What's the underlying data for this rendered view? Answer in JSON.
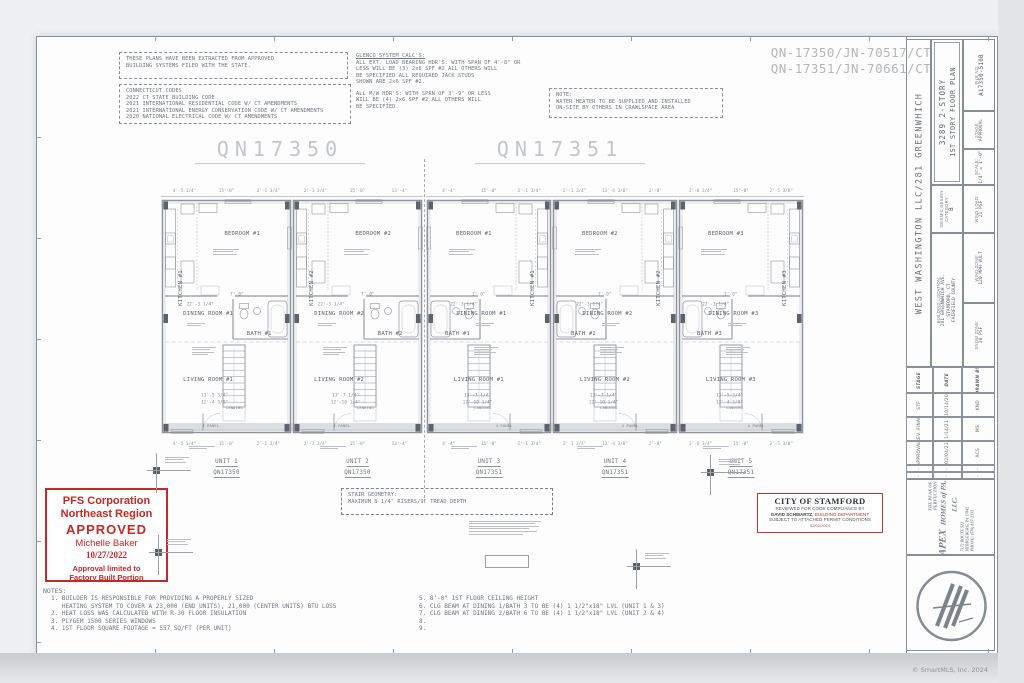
{
  "header": {
    "extract_notice": [
      "THESE PLANS HAVE BEEN EXTRACTED FROM APPROVED",
      "BUILDING SYSTEMS FILED WITH THE STATE."
    ],
    "codes": {
      "title": "CONNECTICUT CODES",
      "items": [
        "2022 CT STATE BUILDING CODE",
        "2021 INTERNATIONAL RESIDENTIAL CODE W/ CT AMENDMENTS",
        "2021 INTERNATIONAL ENERGY CONSERVATION CODE W/ CT AMENDMENTS",
        "2020 NATIONAL ELECTRICAL CODE W/ CT AMENDMENTS"
      ]
    },
    "glenco": {
      "title": "GLENCO SYSTEM CALC'S:",
      "para1": [
        "ALL EXT. LOAD BEARING HDR'S: WITH SPAN OF 4'-8\" OR",
        "LESS WILL BE (3) 2x6 SPF #2 ALL OTHERS WILL",
        "BE SPECIFIED ALL REQUIRED JACK STUDS",
        "SHOWN ARE 2x6 SPF #2."
      ],
      "para2": [
        "ALL M/W HDR'S: WITH SPAN OF 3'-9\" OR LESS",
        "WILL BE (4) 2x6 SPF #2 ALL OTHERS WILL",
        "BE SPECIFIED."
      ]
    },
    "water_note": {
      "title": "NOTE:",
      "lines": [
        "WATER HEATER TO BE SUPPLIED AND INSTALLED",
        "ON-SITE BY OTHERS IN CRAWLSPACE AREA"
      ]
    },
    "job_numbers": [
      "QN-17350/JN-70517/CT",
      "QN-17351/JN-70661/CT"
    ]
  },
  "plans": [
    {
      "title": "QN17350",
      "units": [
        {
          "name": "UNIT 1",
          "model": "QN17350",
          "mirror": false,
          "rooms": {
            "bedroom": "BEDROOM #1",
            "kitchen": "KITCHEN #1",
            "dining": "DINING ROOM #1",
            "bath": "BATH #1",
            "living": "LIVING ROOM #1",
            "landing": "LANDING",
            "door": "4 PANEL"
          },
          "dims_top": [
            "4'-5 1/4\"",
            "15'-0\"",
            "2'-1 3/4\""
          ],
          "dims_interior": [
            "7'-0\"",
            "22'-3 1/4\""
          ],
          "dims_bottom": [
            "13'-5 3/4\"",
            "12'-4 3/8\""
          ]
        },
        {
          "name": "UNIT 2",
          "model": "QN17350",
          "mirror": false,
          "rooms": {
            "bedroom": "BEDROOM #2",
            "kitchen": "KITCHEN #2",
            "dining": "DINING ROOM #2",
            "bath": "BATH #2",
            "living": "LIVING ROOM #2",
            "landing": "LANDING",
            "door": "4 PANEL"
          },
          "dims_top": [
            "2'-1 3/4\"",
            "15'-0\"",
            "13'-4\""
          ],
          "dims_interior": [
            "7'-0\"",
            "22'-3 1/4\""
          ],
          "dims_bottom": [
            "13'-7 1/4\"",
            "12'-10 1/4\""
          ]
        }
      ]
    },
    {
      "title": "QN17351",
      "units": [
        {
          "name": "UNIT 3",
          "model": "QN17351",
          "mirror": true,
          "rooms": {
            "bedroom": "BEDROOM #1",
            "kitchen": "KITCHEN #1",
            "dining": "DINING ROOM #1",
            "bath": "BATH #1",
            "living": "LIVING ROOM #1",
            "landing": "LANDING",
            "door": "4 PANEL"
          },
          "dims_top": [
            "4'-4\"",
            "15'-0\"",
            "2'-1 3/4\""
          ],
          "dims_interior": [
            "7'-0\"",
            "22'-3 1/4\""
          ],
          "dims_bottom": [
            "13'-7 1/4\"",
            "12'-10 1/4\""
          ]
        },
        {
          "name": "UNIT 4",
          "model": "QN17351",
          "mirror": true,
          "rooms": {
            "bedroom": "BEDROOM #2",
            "kitchen": "KITCHEN #2",
            "dining": "DINING ROOM #2",
            "bath": "BATH #2",
            "living": "LIVING ROOM #2",
            "landing": "LANDING",
            "door": "4 PANEL"
          },
          "dims_top": [
            "2'-1 3/4\"",
            "13'-4 3/8\"",
            "2'-8\""
          ],
          "dims_interior": [
            "7'-0\"",
            "22'-3 1/4\""
          ],
          "dims_bottom": [
            "13'-7 1/4\"",
            "12'-10 1/4\""
          ]
        },
        {
          "name": "UNIT 5",
          "model": "QN17351",
          "mirror": true,
          "rooms": {
            "bedroom": "BEDROOM #3",
            "kitchen": "KITCHEN #3",
            "dining": "DINING ROOM #3",
            "bath": "BATH #3",
            "living": "LIVING ROOM #3",
            "landing": "LANDING",
            "door": "4 PANEL"
          },
          "dims_top": [
            "2'-6 3/4\"",
            "15'-0\"",
            "2'-5 3/8\""
          ],
          "dims_interior": [
            "7'-0\"",
            "22'-3 1/4\""
          ],
          "dims_bottom": [
            "13'-5 3/4\"",
            "12'-4 3/8\""
          ]
        }
      ]
    }
  ],
  "stair_geometry": {
    "lines": [
      "STAIR GEOMETRY:",
      "MAXIMUM 8 1/4\" RISERS/9\" TREAD DEPTH"
    ]
  },
  "pfs_stamp": {
    "line1": "PFS Corporation",
    "line2": "Northeast Region",
    "line3": "APPROVED",
    "line4": "Michelle Baker",
    "line5": "10/27/2022",
    "line6": "Approval limited to",
    "line7": "Factory Built Portion"
  },
  "stamford_stamp": {
    "title": "CITY OF STAMFORD",
    "line1": "REVIEWED FOR CODE COMPLIANCE BY",
    "name": "DAVID SCHWARTZ,",
    "dept": " BUILDING DEPARTMENT",
    "line3": "SUBJECT TO ATTACHED PERMIT CONDITIONS",
    "date": "02/02/2024"
  },
  "notes": {
    "title": "NOTES:",
    "left": [
      "1. BUILDER IS RESPONSIBLE FOR PROVIDING A PROPERLY SIZED",
      "   HEATING SYSTEM TO COVER A 23,000 (END UNITS), 21,000 (CENTER UNITS) BTU LOSS",
      "2. HEAT LOSS WAS CALCULATED WITH R-30 FLOOR INSULATION",
      "3. PLYGEM 1500 SERIES WINDOWS",
      "4. 1ST FLOOR SQUARE FOOTAGE = 557 SQ/FT (PER UNIT)"
    ],
    "right": [
      "5. 8'-0\" 1ST FLOOR CEILING HEIGHT",
      "6. CLG BEAM AT DINING 1/BATH 3 TO BE (4) 1 1/2\"x18\" LVL (UNIT 1 & 3)",
      "7. CLG BEAM AT DINING 2/BATH 6 TO BE (4) 1 1/2\"x18\" LVL (UNIT 2 & 4)",
      "8.",
      "9."
    ]
  },
  "title_block": {
    "client": "WEST WASHINGTON LLC/281 GREENWHICH",
    "model": "3289 2-STORY",
    "sheet_title": "1ST STORY FLOOR PLAN",
    "file_no": {
      "label": "FILE NO.",
      "value": "A17350-510B"
    },
    "stage": {
      "label": "STAGE:",
      "value": "APPROVAL"
    },
    "scale": {
      "label": "SCALE:",
      "value": "1/4\" = 1'-0\""
    },
    "seismic": {
      "label": "SEISMIC DESIGN CATEGORY:",
      "value": "B"
    },
    "wind_load": {
      "label": "WIND LOAD:",
      "value": "21 PSF"
    },
    "location": {
      "label": "BUILDING LOCATION:",
      "lines": [
        "281 GREENWHICH AVE.",
        "STAMFORD, CT",
        "FAIRFIELD COUNTY"
      ]
    },
    "wind_zone": {
      "label": "WIND ZONE:",
      "value": "120 MPH VULT"
    },
    "snow_zone": {
      "label": "SNOW ZONE:",
      "value": "30 PSF"
    },
    "revisions": {
      "headers": [
        "STAGE",
        "DATE",
        "DRAWN BY"
      ],
      "rows": [
        [
          "STF",
          "10/14/20",
          "KND"
        ],
        [
          "REV. FINAL",
          "1/14/21",
          "MS"
        ],
        [
          "APPROVAL",
          "02/04/21",
          "ACS"
        ],
        [
          "-",
          "-",
          "-"
        ],
        [
          "-",
          "-",
          "-"
        ]
      ]
    },
    "firm": {
      "tagline1": "THE PEAK OF",
      "tagline2": "PERFECTION",
      "name": "APEX",
      "name2": "HOMES of PA, LLC.",
      "addr1": "7172 ROUTE 522",
      "addr2": "MIDDLEBURG, PA 17842",
      "phone": "PHONE: (570) 837-2333"
    }
  },
  "watermark": "© SmartMLS, Inc. 2024",
  "colors": {
    "red": "#c22a28",
    "line": "#8e949b",
    "faint": "#b9bdc2",
    "text": "#6f757d",
    "title": "#c2c6ca",
    "dark": "#5d636b"
  }
}
